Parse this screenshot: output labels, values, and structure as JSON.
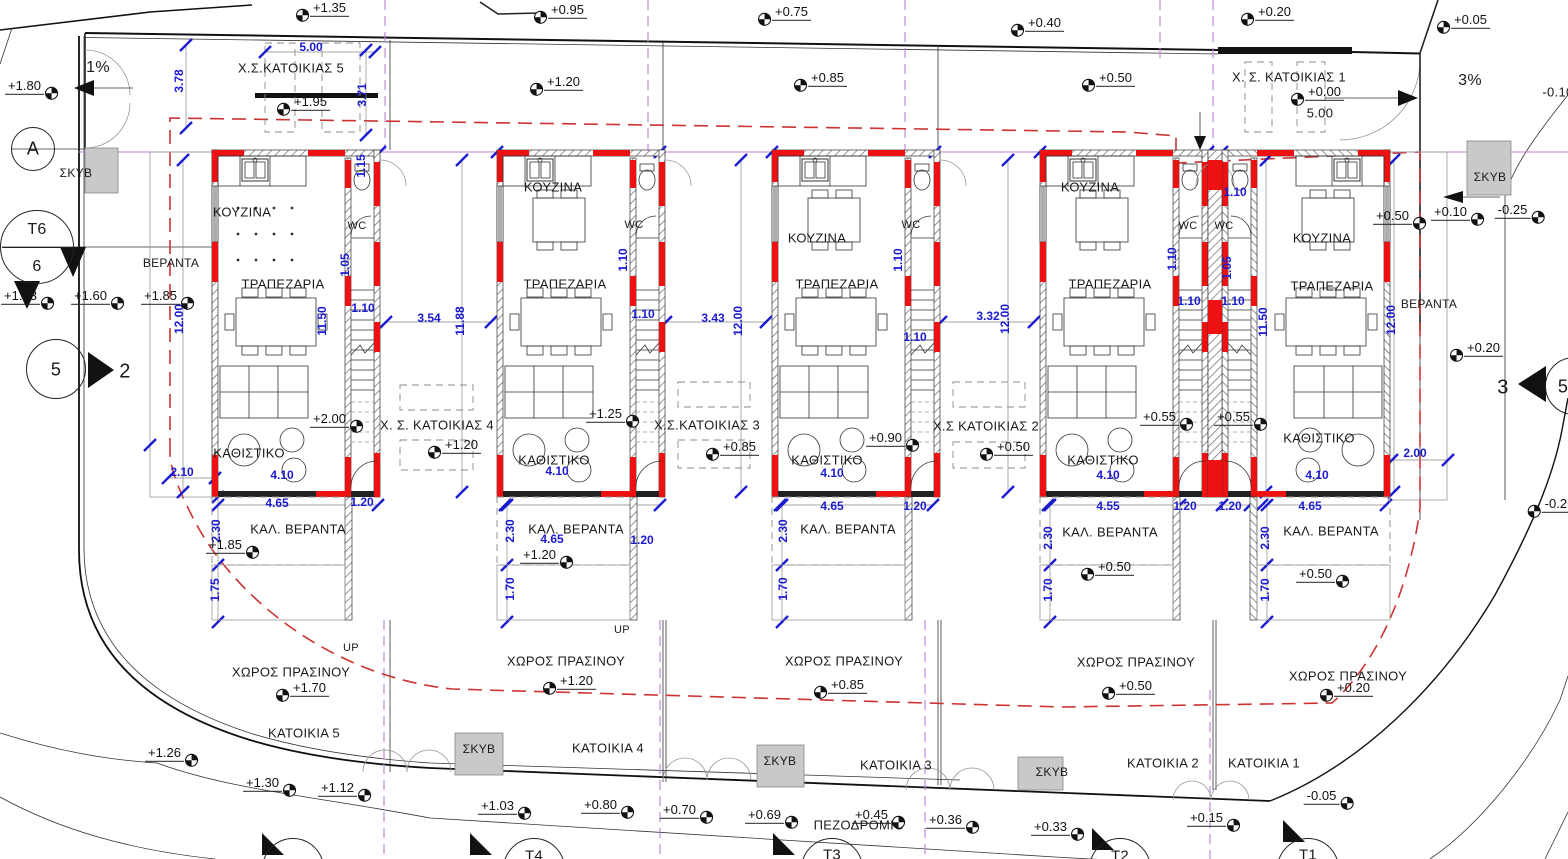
{
  "drawing": {
    "type": "architectural-site-plan",
    "language": "el",
    "units": "m",
    "colors": {
      "dimension_blue": "#1b1bd0",
      "wall_red": "#ee1111",
      "setback_red_dash": "#cc3333",
      "lot_line_purple": "#bd7fd8",
      "concrete_gray": "#c9c9c9"
    }
  },
  "labels": [
    {
      "n": "room-kitchen-house5",
      "t": "ΚΟΥΖΙΝΑ",
      "x": 242,
      "y": 212
    },
    {
      "n": "room-kitchen-house4",
      "t": "ΚΟΥΖΙΝΑ",
      "x": 553,
      "y": 187
    },
    {
      "n": "room-kitchen-house3",
      "t": "ΚΟΥΖΙΝΑ",
      "x": 817,
      "y": 238
    },
    {
      "n": "room-kitchen-house2",
      "t": "ΚΟΥΖΙΝΑ",
      "x": 1090,
      "y": 187
    },
    {
      "n": "room-kitchen-house1",
      "t": "ΚΟΥΖΙΝΑ",
      "x": 1322,
      "y": 238
    },
    {
      "n": "room-dining-house5",
      "t": "ΤΡΑΠΕΖΑΡΙΑ",
      "x": 283,
      "y": 284
    },
    {
      "n": "room-dining-house4",
      "t": "ΤΡΑΠΕΖΑΡΙΑ",
      "x": 565,
      "y": 284
    },
    {
      "n": "room-dining-house3",
      "t": "ΤΡΑΠΕΖΑΡΙΑ",
      "x": 837,
      "y": 284
    },
    {
      "n": "room-dining-house2",
      "t": "ΤΡΑΠΕΖΑΡΙΑ",
      "x": 1110,
      "y": 284
    },
    {
      "n": "room-dining-house1",
      "t": "ΤΡΑΠΕΖΑΡΙΑ",
      "x": 1332,
      "y": 286
    },
    {
      "n": "room-living-house5",
      "t": "ΚΑΘΙΣΤΙΚΟ",
      "x": 249,
      "y": 453
    },
    {
      "n": "room-living-house4",
      "t": "ΚΑΘΙΣΤΙΚΟ",
      "x": 554,
      "y": 460
    },
    {
      "n": "room-living-house3",
      "t": "ΚΑΘΙΣΤΙΚΟ",
      "x": 827,
      "y": 460
    },
    {
      "n": "room-living-house2",
      "t": "ΚΑΘΙΣΤΙΚΟ",
      "x": 1103,
      "y": 460
    },
    {
      "n": "room-living-house1",
      "t": "ΚΑΘΙΣΤΙΚΟ",
      "x": 1319,
      "y": 438
    },
    {
      "n": "room-wc-house5",
      "t": "WC",
      "x": 357,
      "y": 226,
      "s": 11
    },
    {
      "n": "room-wc-house4",
      "t": "WC",
      "x": 634,
      "y": 225,
      "s": 11
    },
    {
      "n": "room-wc-house3",
      "t": "WC",
      "x": 911,
      "y": 225,
      "s": 11
    },
    {
      "n": "room-wc-house2",
      "t": "WC",
      "x": 1188,
      "y": 226,
      "s": 11
    },
    {
      "n": "room-wc-house1",
      "t": "WC",
      "x": 1224,
      "y": 226,
      "s": 11
    },
    {
      "n": "area-veranda-left",
      "t": "ΒΕΡΑΝΤΑ",
      "x": 171,
      "y": 263,
      "s": 12
    },
    {
      "n": "area-veranda-right",
      "t": "ΒΕΡΑΝΤΑ",
      "x": 1429,
      "y": 304,
      "s": 12
    },
    {
      "n": "area-cov-veranda-house5",
      "t": "ΚΑΛ. ΒΕΡΑΝΤΑ",
      "x": 298,
      "y": 529
    },
    {
      "n": "area-cov-veranda-house4",
      "t": "ΚΑΛ. ΒΕΡΑΝΤΑ",
      "x": 576,
      "y": 529
    },
    {
      "n": "area-cov-veranda-house3",
      "t": "ΚΑΛ. ΒΕΡΑΝΤΑ",
      "x": 848,
      "y": 529
    },
    {
      "n": "area-cov-veranda-house2",
      "t": "ΚΑΛ. ΒΕΡΑΝΤΑ",
      "x": 1110,
      "y": 532
    },
    {
      "n": "area-green-house5",
      "t": "ΧΩΡΟΣ ΠΡΑΣΙΝΟΥ",
      "x": 291,
      "y": 672
    },
    {
      "n": "area-cov-veranda-house1",
      "t": "ΚΑΛ. ΒΕΡΑΝΤΑ",
      "x": 1331,
      "y": 531
    },
    {
      "n": "area-green-house4",
      "t": "ΧΩΡΟΣ ΠΡΑΣΙΝΟΥ",
      "x": 566,
      "y": 661
    },
    {
      "n": "area-green-house3",
      "t": "ΧΩΡΟΣ ΠΡΑΣΙΝΟΥ",
      "x": 844,
      "y": 661
    },
    {
      "n": "area-green-house2",
      "t": "ΧΩΡΟΣ ΠΡΑΣΙΝΟΥ",
      "x": 1136,
      "y": 662
    },
    {
      "n": "area-green-house1",
      "t": "ΧΩΡΟΣ ΠΡΑΣΙΝΟΥ",
      "x": 1348,
      "y": 676
    },
    {
      "n": "area-parking-house5",
      "t": "Χ.Σ.ΚΑΤΟΙΚΙΑΣ 5",
      "x": 291,
      "y": 68
    },
    {
      "n": "area-parking-house4",
      "t": "Χ. Σ. ΚΑΤΟΙΚΙΑΣ 4",
      "x": 437,
      "y": 425
    },
    {
      "n": "area-parking-house3",
      "t": "Χ.Σ.ΚΑΤΟΙΚΙΑΣ 3",
      "x": 707,
      "y": 425
    },
    {
      "n": "area-parking-house2",
      "t": "Χ.Σ ΚΑΤΟΙΚΙΑΣ 2",
      "x": 986,
      "y": 426
    },
    {
      "n": "area-parking-house1",
      "t": "Χ. Σ. ΚΑΤΟΙΚΙΑΣ 1",
      "x": 1289,
      "y": 77
    },
    {
      "n": "lot-house5",
      "t": "ΚΑΤΟΙΚΙΑ 5",
      "x": 304,
      "y": 733
    },
    {
      "n": "lot-house4",
      "t": "ΚΑΤΟΙΚΙΑ 4",
      "x": 608,
      "y": 748
    },
    {
      "n": "lot-house3",
      "t": "ΚΑΤΟΙΚΙΑ 3",
      "x": 896,
      "y": 765
    },
    {
      "n": "lot-house2",
      "t": "ΚΑΤΟΙΚΙΑ 2",
      "x": 1163,
      "y": 763
    },
    {
      "n": "lot-house1",
      "t": "ΚΑΤΟΙΚΙΑ 1",
      "x": 1264,
      "y": 763
    },
    {
      "n": "area-sidewalk",
      "t": "ΠΕΖΟΔΡΟΜΙΟ",
      "x": 859,
      "y": 825
    },
    {
      "n": "concrete-skyv-topleft",
      "t": "ΣΚΥΒ",
      "x": 76,
      "y": 173,
      "s": 12
    },
    {
      "n": "concrete-skyv-topright",
      "t": "ΣΚΥΒ",
      "x": 1490,
      "y": 177,
      "s": 12
    },
    {
      "n": "concrete-skyv-bottom5",
      "t": "ΣΚΥΒ",
      "x": 479,
      "y": 749,
      "s": 12
    },
    {
      "n": "concrete-skyv-bottom3",
      "t": "ΣΚΥΒ",
      "x": 780,
      "y": 761,
      "s": 12
    },
    {
      "n": "concrete-skyv-bottom2",
      "t": "ΣΚΥΒ",
      "x": 1052,
      "y": 772,
      "s": 12
    },
    {
      "n": "slope-left",
      "t": "1%",
      "x": 98,
      "y": 68,
      "s": 16
    },
    {
      "n": "slope-right",
      "t": "3%",
      "x": 1470,
      "y": 81,
      "s": 16
    },
    {
      "n": "stairs-up-house5",
      "t": "UP",
      "x": 351,
      "y": 648,
      "s": 11
    },
    {
      "n": "stairs-up-house4",
      "t": "UP",
      "x": 622,
      "y": 630,
      "s": 11
    },
    {
      "n": "section-arrow-2",
      "t": "2",
      "x": 125,
      "y": 372,
      "s": 20
    },
    {
      "n": "section-arrow-3",
      "t": "3",
      "x": 1503,
      "y": 388,
      "s": 20
    },
    {
      "n": "level-clipped-topright",
      "t": "-0.10",
      "x": 1558,
      "y": 92
    },
    {
      "n": "dim-parking1-width",
      "t": "5.00",
      "x": 1320,
      "y": 113
    },
    {
      "n": "grid-circle-a-label",
      "t": "A",
      "x": 33,
      "y": 149,
      "s": 18
    },
    {
      "n": "survey-t6-label",
      "t": "T6",
      "x": 37,
      "y": 230,
      "s": 16
    },
    {
      "n": "survey-t6-sub",
      "t": "6",
      "x": 37,
      "y": 267,
      "s": 16
    },
    {
      "n": "section-circle-5-label",
      "t": "5",
      "x": 56,
      "y": 370,
      "s": 18
    },
    {
      "n": "section-circle-5r-label",
      "t": "5",
      "x": 1563,
      "y": 387,
      "s": 18
    },
    {
      "n": "survey-t4-label",
      "t": "T4",
      "x": 534,
      "y": 856,
      "s": 15
    },
    {
      "n": "survey-t3-label",
      "t": "T3",
      "x": 832,
      "y": 855,
      "s": 15
    },
    {
      "n": "survey-t2-label",
      "t": "T2",
      "x": 1120,
      "y": 856,
      "s": 15
    },
    {
      "n": "survey-t1-label",
      "t": "T1",
      "x": 1308,
      "y": 855,
      "s": 15
    },
    {
      "n": "dim-parking5-width",
      "t": "5.00",
      "x": 311,
      "y": 47,
      "c": "b"
    },
    {
      "n": "dim-3-78",
      "t": "3.78",
      "x": 179,
      "y": 81,
      "c": "b",
      "r": 1
    },
    {
      "n": "dim-3-71",
      "t": "3.71",
      "x": 362,
      "y": 95,
      "c": "b",
      "r": 1
    },
    {
      "n": "dim-1-15",
      "t": "1.15",
      "x": 361,
      "y": 166,
      "c": "b",
      "r": 1
    },
    {
      "n": "dim-11-50-h5",
      "t": "11.50",
      "x": 322,
      "y": 321,
      "c": "b",
      "r": 1
    },
    {
      "n": "dim-1-05-h5",
      "t": "1.05",
      "x": 345,
      "y": 265,
      "c": "b",
      "r": 1
    },
    {
      "n": "dim-1-10-h5",
      "t": "1.10",
      "x": 363,
      "y": 308,
      "c": "b"
    },
    {
      "n": "dim-12-00-left",
      "t": "12.00",
      "x": 179,
      "y": 319,
      "c": "b",
      "r": 1
    },
    {
      "n": "dim-2-10",
      "t": "2.10",
      "x": 182,
      "y": 472,
      "c": "b"
    },
    {
      "n": "dim-4-10-h5",
      "t": "4.10",
      "x": 282,
      "y": 475,
      "c": "b"
    },
    {
      "n": "dim-4-65-h5",
      "t": "4.65",
      "x": 277,
      "y": 503,
      "c": "b"
    },
    {
      "n": "dim-1-20-h5",
      "t": "1.20",
      "x": 362,
      "y": 502,
      "c": "b"
    },
    {
      "n": "dim-2-30-h5",
      "t": "2.30",
      "x": 216,
      "y": 531,
      "c": "b",
      "r": 1
    },
    {
      "n": "dim-1-75-h5",
      "t": "1.75",
      "x": 215,
      "y": 590,
      "c": "b",
      "r": 1
    },
    {
      "n": "dim-3-54",
      "t": "3.54",
      "x": 429,
      "y": 318,
      "c": "b"
    },
    {
      "n": "dim-11-88",
      "t": "11.88",
      "x": 460,
      "y": 321,
      "c": "b",
      "r": 1
    },
    {
      "n": "dim-1-10-h4a",
      "t": "1.10",
      "x": 623,
      "y": 260,
      "c": "b",
      "r": 1
    },
    {
      "n": "dim-1-10-h4b",
      "t": "1.10",
      "x": 643,
      "y": 314,
      "c": "b"
    },
    {
      "n": "dim-4-10-h4",
      "t": "4.10",
      "x": 557,
      "y": 471,
      "c": "b"
    },
    {
      "n": "dim-4-65-h4",
      "t": "4.65",
      "x": 552,
      "y": 539,
      "c": "b"
    },
    {
      "n": "dim-1-20-h4",
      "t": "1.20",
      "x": 642,
      "y": 540,
      "c": "b"
    },
    {
      "n": "dim-2-30-h4",
      "t": "2.30",
      "x": 510,
      "y": 531,
      "c": "b",
      "r": 1
    },
    {
      "n": "dim-1-70-h4",
      "t": "1.70",
      "x": 510,
      "y": 589,
      "c": "b",
      "r": 1
    },
    {
      "n": "dim-3-43",
      "t": "3.43",
      "x": 713,
      "y": 318,
      "c": "b"
    },
    {
      "n": "dim-12-00-a",
      "t": "12.00",
      "x": 738,
      "y": 321,
      "c": "b",
      "r": 1
    },
    {
      "n": "dim-1-10-h3a",
      "t": "1.10",
      "x": 898,
      "y": 260,
      "c": "b",
      "r": 1
    },
    {
      "n": "dim-1-10-h3b",
      "t": "1.10",
      "x": 915,
      "y": 337,
      "c": "b"
    },
    {
      "n": "dim-4-10-h3",
      "t": "4.10",
      "x": 832,
      "y": 473,
      "c": "b"
    },
    {
      "n": "dim-4-65-h3",
      "t": "4.65",
      "x": 832,
      "y": 506,
      "c": "b"
    },
    {
      "n": "dim-1-20-h3",
      "t": "1.20",
      "x": 915,
      "y": 506,
      "c": "b"
    },
    {
      "n": "dim-2-30-h3",
      "t": "2.30",
      "x": 783,
      "y": 531,
      "c": "b",
      "r": 1
    },
    {
      "n": "dim-1-70-h3",
      "t": "1.70",
      "x": 783,
      "y": 589,
      "c": "b",
      "r": 1
    },
    {
      "n": "dim-3-32",
      "t": "3.32",
      "x": 988,
      "y": 316,
      "c": "b"
    },
    {
      "n": "dim-12-00-b",
      "t": "12.00",
      "x": 1005,
      "y": 319,
      "c": "b",
      "r": 1
    },
    {
      "n": "dim-1-10-h2a",
      "t": "1.10",
      "x": 1172,
      "y": 259,
      "c": "b",
      "r": 1
    },
    {
      "n": "dim-1-10-h2b",
      "t": "1.10",
      "x": 1189,
      "y": 301,
      "c": "b"
    },
    {
      "n": "dim-1-05-h1",
      "t": "1.05",
      "x": 1227,
      "y": 268,
      "c": "b",
      "r": 1
    },
    {
      "n": "dim-1-10-h1a",
      "t": "1.10",
      "x": 1233,
      "y": 301,
      "c": "b"
    },
    {
      "n": "dim-1-10-h1b",
      "t": "1.10",
      "x": 1235,
      "y": 192,
      "c": "b"
    },
    {
      "n": "dim-4-10-h2",
      "t": "4.10",
      "x": 1108,
      "y": 475,
      "c": "b"
    },
    {
      "n": "dim-4-55-h2",
      "t": "4.55",
      "x": 1108,
      "y": 506,
      "c": "b"
    },
    {
      "n": "dim-1-20-h2",
      "t": "1.20",
      "x": 1185,
      "y": 506,
      "c": "b"
    },
    {
      "n": "dim-1-20-h1",
      "t": "1.20",
      "x": 1230,
      "y": 506,
      "c": "b"
    },
    {
      "n": "dim-2-30-h2",
      "t": "2.30",
      "x": 1048,
      "y": 538,
      "c": "b",
      "r": 1
    },
    {
      "n": "dim-1-70-h2",
      "t": "1.70",
      "x": 1048,
      "y": 590,
      "c": "b",
      "r": 1
    },
    {
      "n": "dim-11-50-h1",
      "t": "11.50",
      "x": 1263,
      "y": 322,
      "c": "b",
      "r": 1
    },
    {
      "n": "dim-4-10-h1",
      "t": "4.10",
      "x": 1317,
      "y": 475,
      "c": "b"
    },
    {
      "n": "dim-4-65-h1",
      "t": "4.65",
      "x": 1310,
      "y": 506,
      "c": "b"
    },
    {
      "n": "dim-2-30-h1",
      "t": "2.30",
      "x": 1265,
      "y": 538,
      "c": "b",
      "r": 1
    },
    {
      "n": "dim-1-70-h1",
      "t": "1.70",
      "x": 1265,
      "y": 590,
      "c": "b",
      "r": 1
    },
    {
      "n": "dim-12-00-right",
      "t": "12.00",
      "x": 1391,
      "y": 320,
      "c": "b",
      "r": 1
    },
    {
      "n": "dim-2-00-right",
      "t": "2.00",
      "x": 1415,
      "y": 453,
      "c": "b"
    }
  ],
  "levels": [
    {
      "n": "level-road-1",
      "t": "+1.35",
      "x": 322,
      "y": 10,
      "s": "l"
    },
    {
      "n": "level-road-2",
      "t": "+0.95",
      "x": 560,
      "y": 12,
      "s": "l"
    },
    {
      "n": "level-road-3",
      "t": "+0.75",
      "x": 784,
      "y": 14,
      "s": "l"
    },
    {
      "n": "level-road-4",
      "t": "+0.40",
      "x": 1037,
      "y": 25,
      "s": "l"
    },
    {
      "n": "level-road-5",
      "t": "+0.20",
      "x": 1267,
      "y": 14,
      "s": "l"
    },
    {
      "n": "level-road-6",
      "t": "+0.05",
      "x": 1463,
      "y": 22,
      "s": "l"
    },
    {
      "n": "level-entry-left",
      "t": "+1.80",
      "x": 32,
      "y": 88,
      "s": "r"
    },
    {
      "n": "level-front-5",
      "t": "+1.20",
      "x": 556,
      "y": 84,
      "s": "l"
    },
    {
      "n": "level-front-3",
      "t": "+0.85",
      "x": 820,
      "y": 80,
      "s": "l"
    },
    {
      "n": "level-front-2",
      "t": "+0.50",
      "x": 1108,
      "y": 80,
      "s": "l"
    },
    {
      "n": "level-parking5",
      "t": "+1.95",
      "x": 303,
      "y": 104,
      "s": "l"
    },
    {
      "n": "level-parking1",
      "t": "+0.00",
      "x": 1317,
      "y": 94,
      "s": "l"
    },
    {
      "n": "level-west-1",
      "t": "+1.63",
      "x": 28,
      "y": 298,
      "s": "r"
    },
    {
      "n": "level-west-2",
      "t": "+1.60",
      "x": 98,
      "y": 298,
      "s": "r"
    },
    {
      "n": "level-west-3",
      "t": "+1.85",
      "x": 168,
      "y": 298,
      "s": "r"
    },
    {
      "n": "level-entry-h5",
      "t": "+2.00",
      "x": 337,
      "y": 421,
      "s": "r"
    },
    {
      "n": "level-parking4",
      "t": "+1.20",
      "x": 454,
      "y": 447,
      "s": "l"
    },
    {
      "n": "level-entry-h4",
      "t": "+1.25",
      "x": 613,
      "y": 416,
      "s": "r"
    },
    {
      "n": "level-parking3",
      "t": "+0.85",
      "x": 732,
      "y": 449,
      "s": "l"
    },
    {
      "n": "level-entry-h3",
      "t": "+0.90",
      "x": 893,
      "y": 440,
      "s": "r"
    },
    {
      "n": "level-parking2",
      "t": "+0.50",
      "x": 1006,
      "y": 449,
      "s": "l"
    },
    {
      "n": "level-entry-h2",
      "t": "+0.55",
      "x": 1167,
      "y": 419,
      "s": "r"
    },
    {
      "n": "level-entry-h1",
      "t": "+0.55",
      "x": 1241,
      "y": 419,
      "s": "r"
    },
    {
      "n": "level-east-1",
      "t": "+0.50",
      "x": 1400,
      "y": 218,
      "s": "r"
    },
    {
      "n": "level-east-2",
      "t": "+0.10",
      "x": 1458,
      "y": 214,
      "s": "r"
    },
    {
      "n": "level-east-3",
      "t": "-0.25",
      "x": 1520,
      "y": 212,
      "s": "r"
    },
    {
      "n": "level-east-4",
      "t": "+0.20",
      "x": 1476,
      "y": 350,
      "s": "l"
    },
    {
      "n": "level-east-5",
      "t": "-0.25",
      "x": 1552,
      "y": 506,
      "s": "l"
    },
    {
      "n": "level-veranda-h5",
      "t": "+1.85",
      "x": 233,
      "y": 547,
      "s": "r"
    },
    {
      "n": "level-green-h5",
      "t": "+1.70",
      "x": 302,
      "y": 690,
      "s": "l"
    },
    {
      "n": "level-veranda-h4",
      "t": "+1.20",
      "x": 547,
      "y": 557,
      "s": "r"
    },
    {
      "n": "level-green-h4",
      "t": "+1.20",
      "x": 569,
      "y": 683,
      "s": "l"
    },
    {
      "n": "level-green-h3",
      "t": "+0.85",
      "x": 840,
      "y": 687,
      "s": "l"
    },
    {
      "n": "level-green-h2",
      "t": "+0.50",
      "x": 1128,
      "y": 688,
      "s": "l"
    },
    {
      "n": "level-green-h1",
      "t": "+0.20",
      "x": 1346,
      "y": 690,
      "s": "l"
    },
    {
      "n": "level-veranda-h2",
      "t": "+0.50",
      "x": 1107,
      "y": 569,
      "s": "l"
    },
    {
      "n": "level-veranda-h1",
      "t": "+0.50",
      "x": 1323,
      "y": 576,
      "s": "r"
    },
    {
      "n": "level-sw-1",
      "t": "+1.26",
      "x": 172,
      "y": 755,
      "s": "r"
    },
    {
      "n": "level-sw-2",
      "t": "+1.30",
      "x": 270,
      "y": 785,
      "s": "r"
    },
    {
      "n": "level-sw-3",
      "t": "+1.12",
      "x": 345,
      "y": 790,
      "s": "r"
    },
    {
      "n": "level-sw-4",
      "t": "+1.03",
      "x": 505,
      "y": 808,
      "s": "r"
    },
    {
      "n": "level-sw-5",
      "t": "+0.80",
      "x": 608,
      "y": 807,
      "s": "r"
    },
    {
      "n": "level-sw-6",
      "t": "+0.70",
      "x": 687,
      "y": 812,
      "s": "r"
    },
    {
      "n": "level-sw-7",
      "t": "+0.69",
      "x": 772,
      "y": 817,
      "s": "r"
    },
    {
      "n": "level-sw-8",
      "t": "+0.45",
      "x": 879,
      "y": 817,
      "s": "r"
    },
    {
      "n": "level-sw-9",
      "t": "+0.36",
      "x": 953,
      "y": 822,
      "s": "r"
    },
    {
      "n": "level-sw-10",
      "t": "+0.33",
      "x": 1058,
      "y": 829,
      "s": "r"
    },
    {
      "n": "level-sw-11",
      "t": "+0.15",
      "x": 1214,
      "y": 820,
      "s": "r"
    },
    {
      "n": "level-sw-12",
      "t": "-0.05",
      "x": 1329,
      "y": 798,
      "s": "r"
    }
  ],
  "markers": [
    {
      "n": "grid-circle-a",
      "x": 33,
      "y": 149,
      "r": 21
    },
    {
      "n": "survey-circle-t6",
      "x": 37,
      "y": 247,
      "r": 36
    },
    {
      "n": "section-circle-5-left",
      "x": 56,
      "y": 369,
      "r": 29
    },
    {
      "n": "section-circle-5-right",
      "x": 1574,
      "y": 386,
      "r": 28
    },
    {
      "n": "survey-circle-t5",
      "x": 293,
      "y": 869,
      "r": 30
    },
    {
      "n": "survey-circle-t4",
      "x": 534,
      "y": 869,
      "r": 30
    },
    {
      "n": "survey-circle-t3",
      "x": 832,
      "y": 869,
      "r": 30
    },
    {
      "n": "survey-circle-t2",
      "x": 1120,
      "y": 869,
      "r": 30
    },
    {
      "n": "survey-circle-t1",
      "x": 1308,
      "y": 869,
      "r": 30
    }
  ]
}
